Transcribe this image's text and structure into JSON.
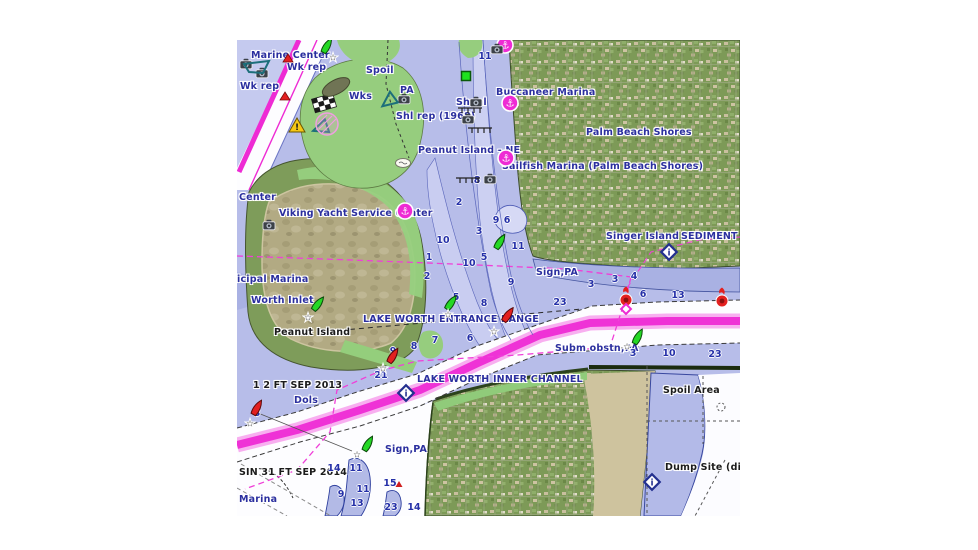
{
  "window": {
    "background": "#ffffff"
  },
  "map": {
    "frame": {
      "x": 237,
      "y": 40,
      "width": 503,
      "height": 476
    },
    "colors": {
      "water": "#b7bde9",
      "water_light": "#c9cdf1",
      "water_shallow": "#a9b1e3",
      "deep_white": "#fdfdff",
      "land_green": "#96cd7e",
      "satellite_green": "#7d9a57",
      "island_dirt": "#b2aa83",
      "magenta": "#ee2bd4",
      "magenta_light": "#f685e8",
      "navy_text": "#2b2f9f",
      "black_text": "#1b1b1b",
      "depth_text": "#2530a8",
      "buoy_green": "#25d825",
      "buoy_red": "#e32020",
      "contour": "#5a66bb"
    },
    "labels": [
      {
        "text": "Marine Center",
        "x": 14,
        "y": 10,
        "color": "navy"
      },
      {
        "text": "Wk rep",
        "x": 50,
        "y": 22,
        "color": "navy"
      },
      {
        "text": "Wk rep",
        "x": 3,
        "y": 41,
        "color": "navy"
      },
      {
        "text": "Spoil",
        "x": 129,
        "y": 25,
        "color": "navy"
      },
      {
        "text": "Wks",
        "x": 112,
        "y": 51,
        "color": "navy"
      },
      {
        "text": "PA",
        "x": 163,
        "y": 45,
        "color": "navy"
      },
      {
        "text": "Shoal",
        "x": 219,
        "y": 57,
        "color": "navy"
      },
      {
        "text": "Shl rep (1968)",
        "x": 159,
        "y": 71,
        "color": "navy"
      },
      {
        "text": "Buccaneer Marina",
        "x": 259,
        "y": 47,
        "color": "navy"
      },
      {
        "text": "Palm Beach Shores",
        "x": 349,
        "y": 87,
        "color": "navy"
      },
      {
        "text": "Peanut Island - NE",
        "x": 181,
        "y": 105,
        "color": "navy"
      },
      {
        "text": "Sailfish Marina (Palm Beach Shores)",
        "x": 265,
        "y": 121,
        "color": "navy"
      },
      {
        "text": "Center",
        "x": 2,
        "y": 152,
        "color": "navy"
      },
      {
        "text": "Viking Yacht Service Center",
        "x": 42,
        "y": 168,
        "color": "navy"
      },
      {
        "text": "Singer Island",
        "x": 369,
        "y": 191,
        "color": "navy"
      },
      {
        "text": "SEDIMENT",
        "x": 444,
        "y": 191,
        "color": "navy"
      },
      {
        "text": "icipal Marina",
        "x": 0,
        "y": 234,
        "color": "navy"
      },
      {
        "text": "Worth Inlet",
        "x": 14,
        "y": 255,
        "color": "navy"
      },
      {
        "text": "Sign,PA",
        "x": 299,
        "y": 227,
        "color": "navy"
      },
      {
        "text": "LAKE WORTH ENTRANCE RANGE",
        "x": 126,
        "y": 274,
        "color": "navy"
      },
      {
        "text": "Subm obstn,PA",
        "x": 318,
        "y": 303,
        "color": "navy"
      },
      {
        "text": "LAKE WORTH INNER CHANNEL",
        "x": 180,
        "y": 334,
        "color": "navy"
      },
      {
        "text": "Dols",
        "x": 57,
        "y": 355,
        "color": "navy"
      },
      {
        "text": "Sign,PA",
        "x": 148,
        "y": 404,
        "color": "navy"
      },
      {
        "text": "Marina",
        "x": 2,
        "y": 454,
        "color": "navy"
      },
      {
        "text": "Peanut Island",
        "x": 37,
        "y": 287,
        "color": "black"
      },
      {
        "text": "1 2 FT SEP 2013",
        "x": 16,
        "y": 340,
        "color": "black"
      },
      {
        "text": "SIN 31 FT SEP 2014",
        "x": 2,
        "y": 427,
        "color": "black"
      },
      {
        "text": "Spoil Area",
        "x": 426,
        "y": 345,
        "color": "black"
      },
      {
        "text": "Dump Site (di",
        "x": 428,
        "y": 422,
        "color": "black"
      }
    ],
    "depths": [
      {
        "v": "11",
        "x": 248,
        "y": 17
      },
      {
        "v": "8",
        "x": 240,
        "y": 141
      },
      {
        "v": "2",
        "x": 222,
        "y": 163
      },
      {
        "v": "9",
        "x": 259,
        "y": 181
      },
      {
        "v": "6",
        "x": 270,
        "y": 181
      },
      {
        "v": "3",
        "x": 242,
        "y": 192
      },
      {
        "v": "10",
        "x": 206,
        "y": 201
      },
      {
        "v": "1",
        "x": 192,
        "y": 218
      },
      {
        "v": "10",
        "x": 232,
        "y": 224
      },
      {
        "v": "5",
        "x": 247,
        "y": 218
      },
      {
        "v": "11",
        "x": 281,
        "y": 207
      },
      {
        "v": "2",
        "x": 190,
        "y": 237
      },
      {
        "v": "9",
        "x": 274,
        "y": 243
      },
      {
        "v": "5",
        "x": 219,
        "y": 258
      },
      {
        "v": "8",
        "x": 247,
        "y": 264
      },
      {
        "v": "23",
        "x": 323,
        "y": 263
      },
      {
        "v": "3",
        "x": 354,
        "y": 245
      },
      {
        "v": "3",
        "x": 378,
        "y": 240
      },
      {
        "v": "4",
        "x": 397,
        "y": 237
      },
      {
        "v": "6",
        "x": 406,
        "y": 255
      },
      {
        "v": "13",
        "x": 441,
        "y": 256
      },
      {
        "v": "9",
        "x": 156,
        "y": 312
      },
      {
        "v": "7",
        "x": 198,
        "y": 301
      },
      {
        "v": "8",
        "x": 177,
        "y": 307
      },
      {
        "v": "6",
        "x": 233,
        "y": 299
      },
      {
        "v": "21",
        "x": 144,
        "y": 336
      },
      {
        "v": "3",
        "x": 20,
        "y": 374
      },
      {
        "v": "3",
        "x": 396,
        "y": 314
      },
      {
        "v": "10",
        "x": 432,
        "y": 314
      },
      {
        "v": "23",
        "x": 478,
        "y": 315
      },
      {
        "v": "14",
        "x": 97,
        "y": 429
      },
      {
        "v": "11",
        "x": 119,
        "y": 429
      },
      {
        "v": "15",
        "x": 153,
        "y": 444
      },
      {
        "v": "11",
        "x": 126,
        "y": 450
      },
      {
        "v": "9",
        "x": 104,
        "y": 455
      },
      {
        "v": "13",
        "x": 120,
        "y": 464
      },
      {
        "v": "23",
        "x": 154,
        "y": 468
      },
      {
        "v": "14",
        "x": 177,
        "y": 468
      }
    ],
    "markers": [
      {
        "type": "marina",
        "x": 268,
        "y": 5
      },
      {
        "type": "marina",
        "x": 273,
        "y": 63
      },
      {
        "type": "marina",
        "x": 269,
        "y": 118
      },
      {
        "type": "marina",
        "x": 168,
        "y": 171
      },
      {
        "type": "green-buoy",
        "x": 90,
        "y": 6,
        "rot": 30
      },
      {
        "type": "green-buoy",
        "x": 263,
        "y": 202,
        "rot": 32
      },
      {
        "type": "green-buoy",
        "x": 214,
        "y": 263,
        "rot": 35
      },
      {
        "type": "green-buoy",
        "x": 81,
        "y": 264,
        "rot": 38
      },
      {
        "type": "green-buoy",
        "x": 131,
        "y": 404,
        "rot": 30
      },
      {
        "type": "green-buoy",
        "x": 401,
        "y": 297,
        "rot": 28
      },
      {
        "type": "red-buoy",
        "x": 271,
        "y": 275,
        "rot": 35
      },
      {
        "type": "red-buoy",
        "x": 156,
        "y": 316,
        "rot": 32
      },
      {
        "type": "red-buoy",
        "x": 20,
        "y": 368,
        "rot": 30
      },
      {
        "type": "red-light-buoy",
        "x": 389,
        "y": 257
      },
      {
        "type": "red-light-buoy",
        "x": 485,
        "y": 258
      },
      {
        "type": "magenta-diamond",
        "x": 389,
        "y": 269
      },
      {
        "type": "star",
        "x": 96,
        "y": 17
      },
      {
        "type": "star",
        "x": 71,
        "y": 277
      },
      {
        "type": "star",
        "x": 211,
        "y": 274
      },
      {
        "type": "star",
        "x": 257,
        "y": 291
      },
      {
        "type": "star",
        "x": 146,
        "y": 328
      },
      {
        "type": "star",
        "x": 13,
        "y": 383
      },
      {
        "type": "star",
        "x": 120,
        "y": 414
      },
      {
        "type": "star",
        "x": 390,
        "y": 306
      },
      {
        "type": "red-triangle",
        "x": 51,
        "y": 18
      },
      {
        "type": "red-triangle",
        "x": 48,
        "y": 56
      },
      {
        "type": "rock-triangle",
        "x": 162,
        "y": 444
      },
      {
        "type": "camera",
        "x": 9,
        "y": 24
      },
      {
        "type": "camera",
        "x": 25,
        "y": 33
      },
      {
        "type": "camera",
        "x": 260,
        "y": 9
      },
      {
        "type": "camera",
        "x": 167,
        "y": 59
      },
      {
        "type": "camera",
        "x": 239,
        "y": 62
      },
      {
        "type": "camera",
        "x": 231,
        "y": 79
      },
      {
        "type": "camera",
        "x": 32,
        "y": 185
      },
      {
        "type": "camera",
        "x": 253,
        "y": 139
      },
      {
        "type": "info-diamond",
        "x": 169,
        "y": 353
      },
      {
        "type": "info-diamond",
        "x": 432,
        "y": 212
      },
      {
        "type": "info-diamond",
        "x": 415,
        "y": 442
      },
      {
        "type": "warning-triangle",
        "x": 60,
        "y": 85
      },
      {
        "type": "checkered-flag",
        "x": 87,
        "y": 63
      },
      {
        "type": "teal-triangle",
        "x": 152,
        "y": 58,
        "rot": -10
      },
      {
        "type": "teal-triangle",
        "x": 85,
        "y": 85,
        "rot": 8
      },
      {
        "type": "teal-quad",
        "x": 21,
        "y": 28
      },
      {
        "type": "white-islet",
        "x": 166,
        "y": 123
      },
      {
        "type": "hatched-circle",
        "x": 90,
        "y": 84
      },
      {
        "type": "spoil-mound",
        "x": 99,
        "y": 47
      },
      {
        "type": "green-square",
        "x": 229,
        "y": 36
      },
      {
        "type": "pier",
        "x": 233,
        "y": 70
      },
      {
        "type": "pier",
        "x": 243,
        "y": 90
      },
      {
        "type": "pier",
        "x": 231,
        "y": 140
      }
    ]
  }
}
